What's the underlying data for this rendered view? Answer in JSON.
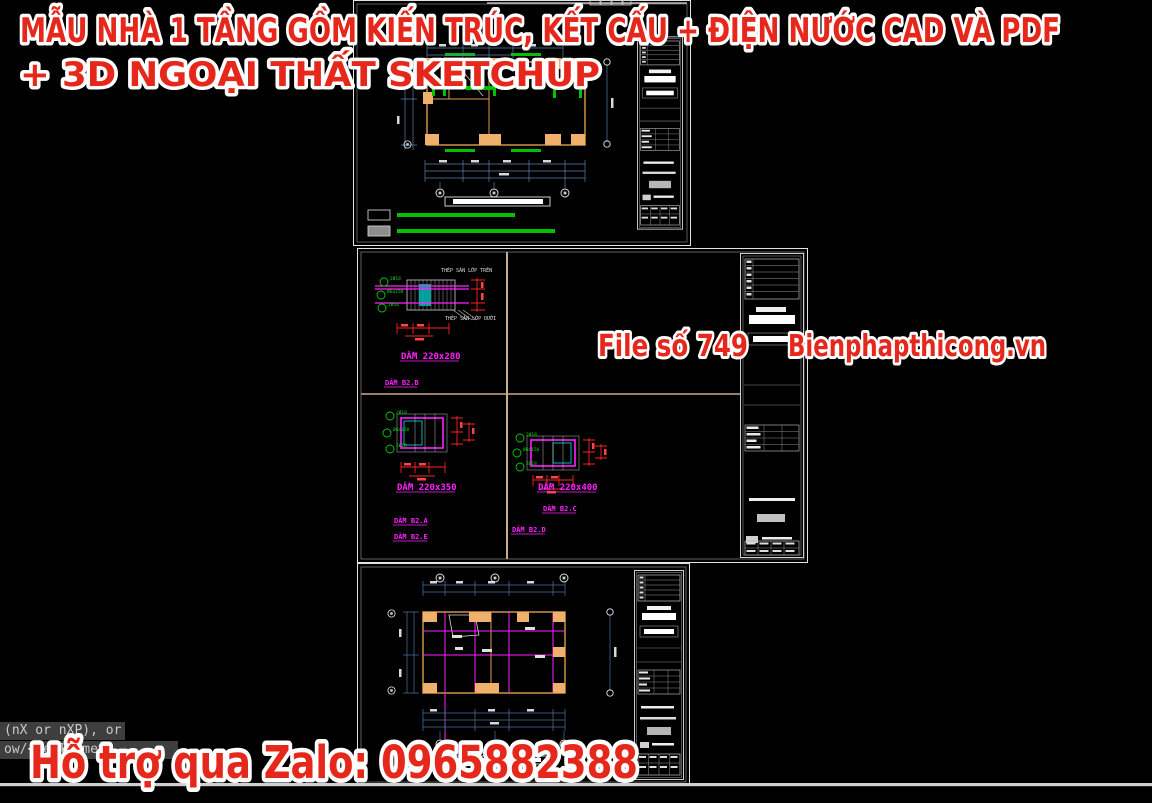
{
  "overlay": {
    "title_line1": "MẪU NHÀ 1 TẦNG GỒM KIẾN TRÚC, KẾT CẤU + ĐIỆN NƯỚC CAD VÀ PDF",
    "title_line2": "+ 3D NGOẠI THẤT SKETCHUP",
    "file_label": "File số 749",
    "site_label": "Bienphapthicong.vn",
    "support_label": "Hỗ trợ qua Zalo: 0965882388"
  },
  "command_line": {
    "line1": "(nX or nXP), or",
    "line2": "ow/<Realtime>:"
  },
  "sheets": {
    "beam_sheet": {
      "note_top": "THÉP SÀN LỚP TRÊN",
      "note_bottom": "THÉP SÀN LỚP DƯỚI",
      "detail1": {
        "size": "DẦM 220x280",
        "name": "DẦM B2.B",
        "callout1": "2Ø18",
        "callout2": "Ø6a150",
        "callout3": "2Ø18"
      },
      "detail2": {
        "size": "DẦM 220x350",
        "name1": "DẦM B2.A",
        "name2": "DẦM B2.E",
        "callout1": "2Ø18",
        "callout2": "Ø6a150",
        "callout3": "2Ø18"
      },
      "detail3": {
        "size": "DẦM 220x400",
        "name1": "DẦM B2.C",
        "name2": "DẦM B2.D",
        "callout1": "2Ø18",
        "callout2": "Ø6a150",
        "callout3": "2Ø18"
      }
    }
  },
  "colors": {
    "overlay_red": "#e6281c",
    "overlay_outline": "#ffffff",
    "canvas_bg": "#000000",
    "cad_orange": "#eeb06a",
    "cad_green": "#00dd00",
    "cad_magenta": "#ff22ff",
    "cad_red": "#ff2222",
    "dim_blue": "#5d7fa8",
    "frame_white": "#e3e3e3",
    "cmd_bg": "#3e3e3e",
    "cmd_text": "#c9c9c9"
  }
}
